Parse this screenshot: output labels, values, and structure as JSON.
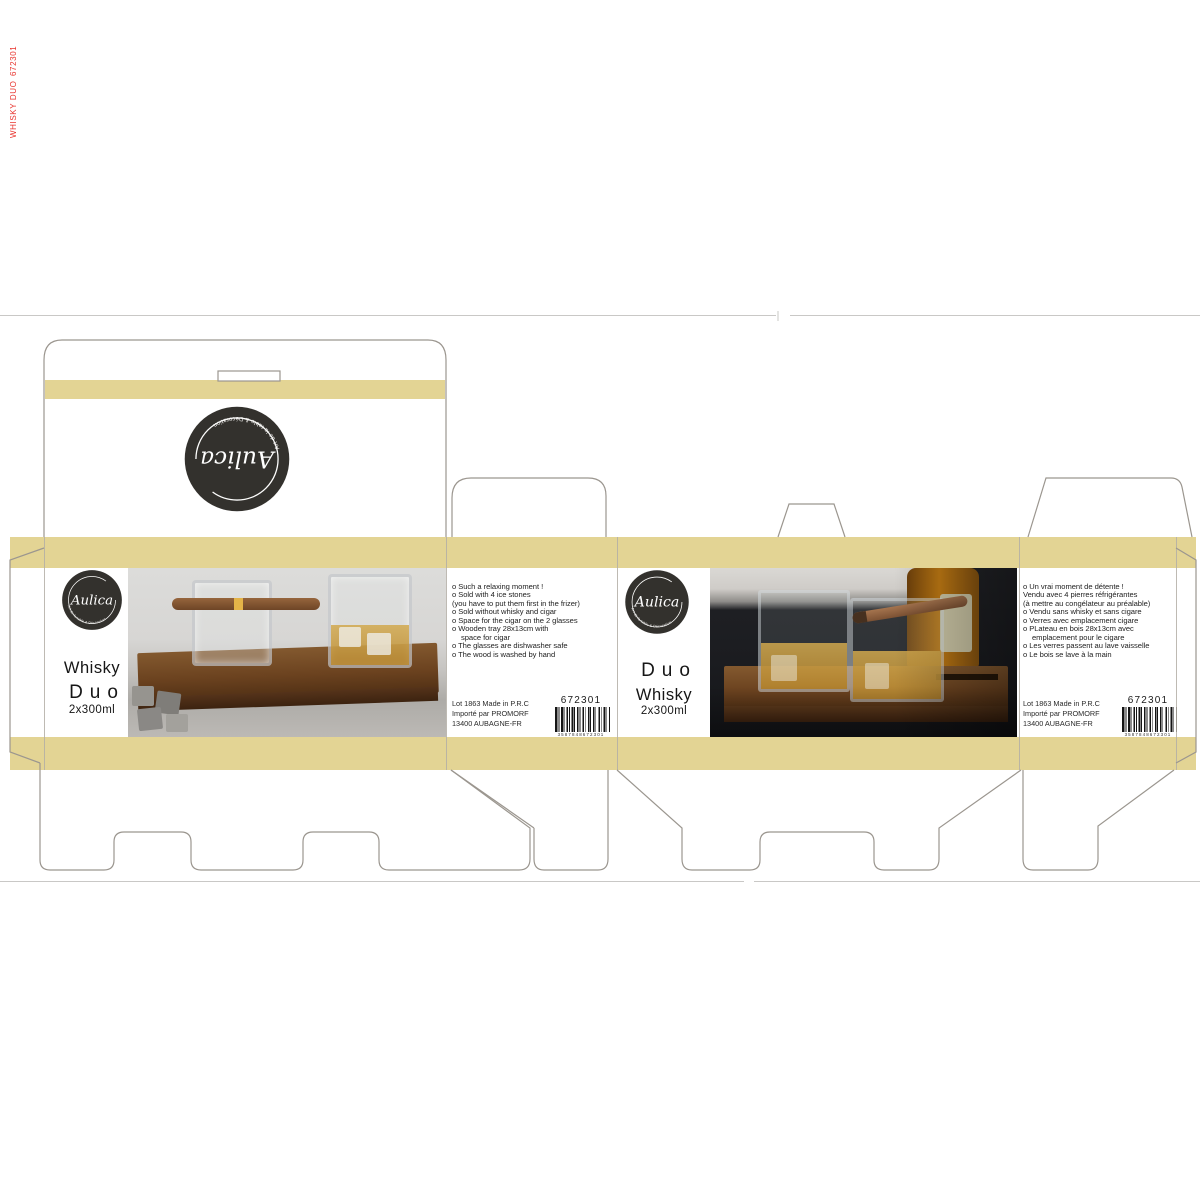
{
  "brand": {
    "name": "Aulica",
    "tagline": "Art de la table & Décoration"
  },
  "colors": {
    "stripe": "#e3d494",
    "logo_bg": "#33312d",
    "cutline": "#9b968f",
    "red_mark": "#e8322c"
  },
  "print_marks": {
    "mark1": "672301",
    "mark2": "WHISKY DUO"
  },
  "front_en": {
    "title1": "Whisky",
    "title2": "Duo",
    "size": "2x300ml"
  },
  "side_en": {
    "bullets": [
      "o Such a relaxing moment !",
      "o Sold with 4 ice stones",
      "(you have to put them first in the frizer)",
      "o Sold without whisky and cigar",
      "o Space for the cigar on the 2 glasses",
      "o Wooden tray 28x13cm with",
      "space for cigar",
      "o The glasses are dishwasher safe",
      "o The wood is washed by hand"
    ],
    "sku": "672301",
    "lot": [
      "Lot 1863 Made in P.R.C",
      "Importé par PROMORF",
      "13400 AUBAGNE-FR"
    ],
    "barcode_digits": "3587848672301"
  },
  "front_fr": {
    "title1": "Duo",
    "title2": "Whisky",
    "size": "2x300ml"
  },
  "side_fr": {
    "bullets": [
      "o Un vrai moment de détente !",
      "Vendu avec 4 pierres réfrigérantes",
      "(à mettre au congélateur au préalable)",
      "o Vendu sans whisky et sans cigare",
      "o Verres avec emplacement cigare",
      "o PLateau en bois 28x13cm avec",
      "emplacement pour le cigare",
      "o Les verres passent au lave vaisselle",
      "o Le bois se lave à la main"
    ],
    "sku": "672301",
    "lot": [
      "Lot 1863 Made in P.R.C",
      "Importé par PROMORF",
      "13400 AUBAGNE-FR"
    ],
    "barcode_digits": "3587848672301"
  }
}
